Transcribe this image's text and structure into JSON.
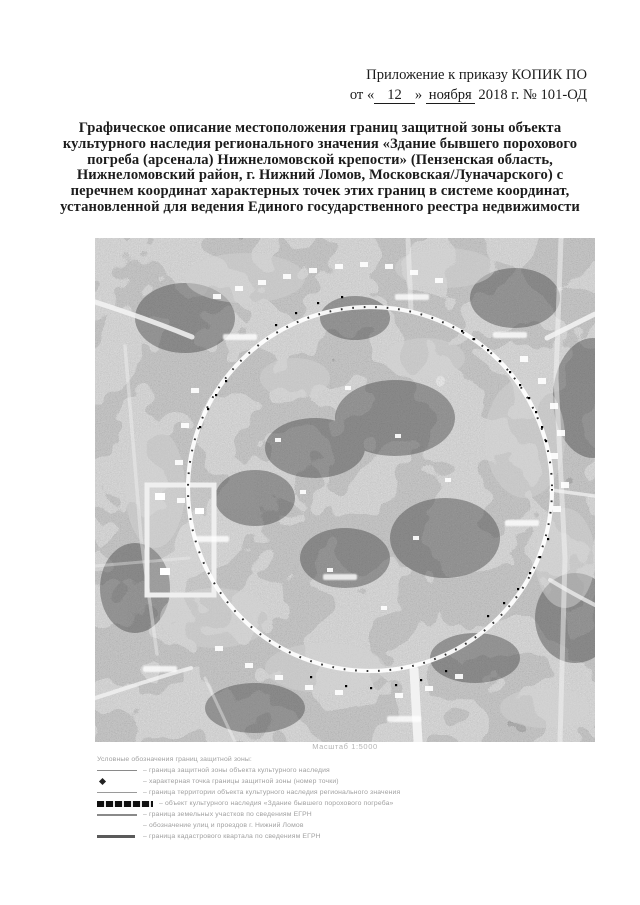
{
  "colors": {
    "page_bg": "#ffffff",
    "text": "#1c1c1c",
    "map_boundary": "#ffffff",
    "boundary_points": "#0a0a0a"
  },
  "header": {
    "line1": "Приложение к приказу КОПИК ПО",
    "date_prefix": "от «",
    "date_day": "12",
    "date_mid": "» ",
    "date_month": "ноября",
    "date_suffix": " 2018 г. № 101-ОД"
  },
  "title_lines": [
    "Графическое описание местоположения границ защитной зоны объекта",
    "культурного наследия регионального значения «Здание бывшего порохового",
    "погреба (арсенала) Нижнеломовской крепости» (Пензенская область,",
    "Нижнеломовский район, г. Нижний Ломов,  Московская/Луначарского)  с",
    "перечнем координат характерных точек этих границ в системе координат,",
    "установленной для ведения Единого государственного реестра недвижимости"
  ],
  "map": {
    "scale_label": "Масштаб 1:5000"
  },
  "legend": {
    "heading": "Условные обозначения границ защитной зоны:",
    "items": [
      {
        "text": "– граница защитной зоны объекта культурного наследия"
      },
      {
        "text": "– характерная точка границы защитной зоны (номер точки)"
      },
      {
        "text": "– граница территории объекта культурного наследия регионального значения"
      },
      {
        "text": "– объект культурного наследия «Здание бывшего порохового погреба»"
      },
      {
        "text": "– граница земельных участков по сведениям ЕГРН"
      },
      {
        "text": "– обозначение улиц и проездов г. Нижний Ломов"
      },
      {
        "text": "– граница кадастрового квартала по сведениям ЕГРН"
      }
    ]
  }
}
